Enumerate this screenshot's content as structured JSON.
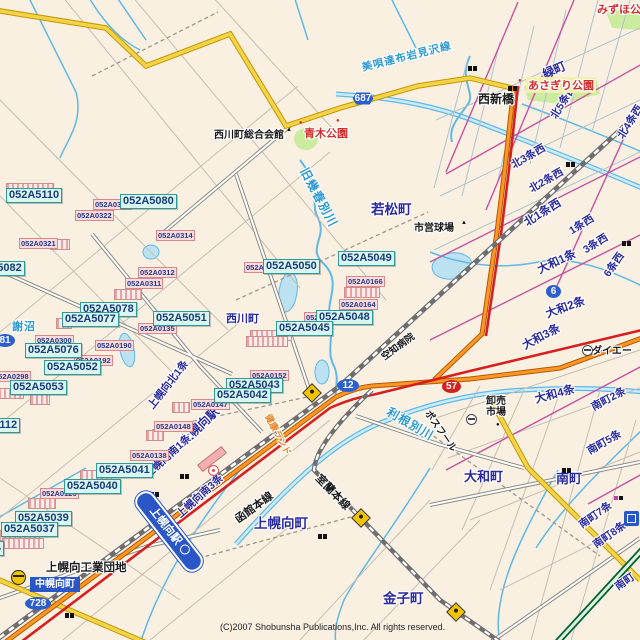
{
  "map": {
    "copyright": "(C)2007 Shobunsha Publications,Inc. All rights reserved.",
    "colors": {
      "bg": "#FAF0E2",
      "route_national": "#FF9726",
      "route_pref_yellow": "#F2D44A",
      "route_red": "#D62020",
      "river": "#5FB8E6",
      "park": "#CBEC9E",
      "railway": "#6E6E6E",
      "label_cyan_bg": "#DAF6F1",
      "label_pink_bg": "#FBDCDC",
      "shield_blue": "#2B5FD0",
      "expressway": "#006030"
    },
    "station_banner": {
      "label": "上幌向駅",
      "x": 121,
      "y": 521,
      "w": 92,
      "rot": 52
    },
    "town_box": {
      "label": "中幌向町",
      "x": 30,
      "y": 577,
      "w": 50
    },
    "code_labels_cyan": [
      {
        "text": "052A5112",
        "x": -36,
        "y": 418
      },
      {
        "text": "052A5110",
        "x": 6,
        "y": 188
      },
      {
        "text": "052A5080",
        "x": 120,
        "y": 194
      },
      {
        "text": "052A5082",
        "x": -32,
        "y": 261
      },
      {
        "text": "052A5078",
        "x": 80,
        "y": 302
      },
      {
        "text": "052A5077",
        "x": 62,
        "y": 312
      },
      {
        "text": "052A5051",
        "x": 153,
        "y": 311
      },
      {
        "text": "052A5076",
        "x": 25,
        "y": 343
      },
      {
        "text": "052A5052",
        "x": 44,
        "y": 360
      },
      {
        "text": "052A5053",
        "x": 10,
        "y": 380
      },
      {
        "text": "052A5050",
        "x": 263,
        "y": 259
      },
      {
        "text": "052A5049",
        "x": 338,
        "y": 251
      },
      {
        "text": "052A5048",
        "x": 316,
        "y": 310
      },
      {
        "text": "052A5045",
        "x": 276,
        "y": 321
      },
      {
        "text": "052A5043",
        "x": 226,
        "y": 378
      },
      {
        "text": "052A5042",
        "x": 214,
        "y": 388
      },
      {
        "text": "052A5041",
        "x": 96,
        "y": 463
      },
      {
        "text": "052A5040",
        "x": 64,
        "y": 479
      },
      {
        "text": "052A5039",
        "x": 15,
        "y": 511
      },
      {
        "text": "052A5037",
        "x": 1,
        "y": 522
      },
      {
        "text": "4",
        "x": -8,
        "y": 541
      }
    ],
    "code_labels_pink": [
      {
        "text": "052A0317",
        "x": 93,
        "y": 199
      },
      {
        "text": "052A0322",
        "x": 75,
        "y": 210
      },
      {
        "text": "052A0321",
        "x": 19,
        "y": 238
      },
      {
        "text": "052A0314",
        "x": 156,
        "y": 230
      },
      {
        "text": "052A0312",
        "x": 138,
        "y": 267
      },
      {
        "text": "052A0311",
        "x": 125,
        "y": 278
      },
      {
        "text": "052A0166",
        "x": 346,
        "y": 276
      },
      {
        "text": "052A0164",
        "x": 339,
        "y": 299
      },
      {
        "text": "052A0190",
        "x": 95,
        "y": 340
      },
      {
        "text": "052A0135",
        "x": 138,
        "y": 323
      },
      {
        "text": "052A0300",
        "x": 35,
        "y": 335
      },
      {
        "text": "052A0192",
        "x": 74,
        "y": 355
      },
      {
        "text": "052A0298",
        "x": -8,
        "y": 371
      },
      {
        "text": "052A0148",
        "x": 154,
        "y": 421
      },
      {
        "text": "052A0147",
        "x": 191,
        "y": 399
      },
      {
        "text": "052A0138",
        "x": 130,
        "y": 450
      },
      {
        "text": "052A0126",
        "x": 40,
        "y": 488
      },
      {
        "text": "052A0152",
        "x": 250,
        "y": 370
      },
      {
        "text": "052A",
        "x": 244,
        "y": 262
      },
      {
        "text": "052",
        "x": 304,
        "y": 312
      }
    ],
    "stack_bars": [
      {
        "x": 6,
        "y": 183,
        "w": 46
      },
      {
        "x": 50,
        "y": 239,
        "w": 18
      },
      {
        "x": 56,
        "y": 318,
        "w": 14
      },
      {
        "x": 114,
        "y": 289,
        "w": 26
      },
      {
        "x": -2,
        "y": 388,
        "w": 24
      },
      {
        "x": 30,
        "y": 394,
        "w": 18
      },
      {
        "x": 172,
        "y": 402,
        "w": 16
      },
      {
        "x": 146,
        "y": 430,
        "w": 16
      },
      {
        "x": 28,
        "y": 498,
        "w": 26
      },
      {
        "x": -2,
        "y": 530,
        "w": 40
      },
      {
        "x": 2,
        "y": 538,
        "w": 40
      },
      {
        "x": 250,
        "y": 330,
        "w": 40
      },
      {
        "x": 246,
        "y": 336,
        "w": 40
      },
      {
        "x": 344,
        "y": 287,
        "w": 34
      },
      {
        "x": 80,
        "y": 470,
        "w": 30
      }
    ],
    "district_labels": [
      {
        "text": "若松町",
        "x": 371,
        "y": 198,
        "fs": 13.5
      },
      {
        "text": "緑町",
        "x": 543,
        "y": 66,
        "fs": 12,
        "rot": -24
      },
      {
        "text": "北5条西",
        "x": 553,
        "y": 110,
        "fs": 10.5,
        "rot": -58
      },
      {
        "text": "北4条西",
        "x": 620,
        "y": 130,
        "fs": 10.5,
        "rot": -58
      },
      {
        "text": "北3条西",
        "x": 512,
        "y": 158,
        "fs": 10.5,
        "rot": -30
      },
      {
        "text": "北2条西",
        "x": 530,
        "y": 182,
        "fs": 10.5,
        "rot": -30
      },
      {
        "text": "北1条西",
        "x": 525,
        "y": 215,
        "fs": 11.5,
        "rot": -32
      },
      {
        "text": "1条西",
        "x": 570,
        "y": 224,
        "fs": 10.5,
        "rot": -32
      },
      {
        "text": "3条西",
        "x": 584,
        "y": 243,
        "fs": 10.5,
        "rot": -32
      },
      {
        "text": "6条西",
        "x": 606,
        "y": 268,
        "fs": 10.5,
        "rot": -55
      },
      {
        "text": "大和1条",
        "x": 538,
        "y": 262,
        "fs": 11.5,
        "rot": -25
      },
      {
        "text": "大和2条",
        "x": 546,
        "y": 306,
        "fs": 11.5,
        "rot": -20
      },
      {
        "text": "大和3条",
        "x": 523,
        "y": 338,
        "fs": 11.5,
        "rot": -28
      },
      {
        "text": "大和4条",
        "x": 535,
        "y": 391,
        "fs": 11.5,
        "rot": -15
      },
      {
        "text": "大和町",
        "x": 464,
        "y": 466,
        "fs": 13
      },
      {
        "text": "南町",
        "x": 556,
        "y": 468,
        "fs": 13
      },
      {
        "text": "南町2条",
        "x": 592,
        "y": 400,
        "fs": 10.5,
        "rot": -28
      },
      {
        "text": "南町5条",
        "x": 588,
        "y": 444,
        "fs": 10.5,
        "rot": -30
      },
      {
        "text": "南町7条",
        "x": 580,
        "y": 518,
        "fs": 10.5,
        "rot": -35
      },
      {
        "text": "南町8条",
        "x": 594,
        "y": 538,
        "fs": 10.5,
        "rot": -35
      },
      {
        "text": "南町",
        "x": 616,
        "y": 580,
        "fs": 10.5,
        "rot": -35
      },
      {
        "text": "上幌向町",
        "x": 254,
        "y": 512,
        "fs": 13.5
      },
      {
        "text": "金子町",
        "x": 383,
        "y": 587,
        "fs": 13.5
      },
      {
        "text": "上幌向北1条",
        "x": 150,
        "y": 400,
        "fs": 10.5,
        "rot": -52
      },
      {
        "text": "上幌向駅",
        "x": 182,
        "y": 434,
        "fs": 12,
        "rot": -44
      },
      {
        "text": "上幌向南1条",
        "x": 146,
        "y": 468,
        "fs": 10.5,
        "rot": -42
      },
      {
        "text": "上幌向南3条",
        "x": 178,
        "y": 508,
        "fs": 10.5,
        "rot": -42
      },
      {
        "text": "西川町",
        "x": 226,
        "y": 310,
        "fs": 11
      }
    ],
    "place_labels": [
      {
        "text": "西川町総合会館",
        "x": 214,
        "y": 126,
        "fs": 10
      },
      {
        "text": "西新橋",
        "x": 478,
        "y": 90,
        "fs": 12
      },
      {
        "text": "市営球場",
        "x": 414,
        "y": 219,
        "fs": 10
      },
      {
        "text": "卸売市場",
        "x": 486,
        "y": 396,
        "fs": 10,
        "w": 24,
        "cls": "wrap"
      },
      {
        "text": "ダイエー",
        "x": 592,
        "y": 342,
        "fs": 10
      },
      {
        "text": "ポスフール",
        "x": 428,
        "y": 404,
        "fs": 9.5,
        "rot": 55
      },
      {
        "text": "函館本線",
        "x": 236,
        "y": 512,
        "fs": 11,
        "rot": -36
      },
      {
        "text": "室蘭本線",
        "x": 318,
        "y": 468,
        "fs": 11,
        "rot": 46
      },
      {
        "text": "空知病院",
        "x": 382,
        "y": 350,
        "fs": 9.5,
        "rot": -36
      },
      {
        "text": "上幌向工業団地",
        "x": 46,
        "y": 559,
        "fs": 11.5
      }
    ],
    "leisure_labels": [
      {
        "text": "健康ランド",
        "x": 268,
        "y": 408,
        "fs": 9,
        "rot": 62
      }
    ],
    "water_labels": [
      {
        "text": "謝沼",
        "x": 12,
        "y": 318,
        "fs": 11
      },
      {
        "text": "旧幾春別川",
        "x": 304,
        "y": 160,
        "fs": 12,
        "rot": 62
      },
      {
        "text": "利根別川",
        "x": 388,
        "y": 402,
        "fs": 12,
        "rot": 30
      },
      {
        "text": "美唄達布岩見沢線",
        "x": 362,
        "y": 60,
        "fs": 10.5,
        "rot": -14
      }
    ],
    "park_labels": [
      {
        "text": "青木公園",
        "x": 304,
        "y": 125,
        "fs": 11
      },
      {
        "text": "あさぎり公園",
        "x": 526,
        "y": 77,
        "fs": 11,
        "cls": "bgyellow"
      },
      {
        "text": "みずほ公園",
        "x": 597,
        "y": 1,
        "fs": 11
      }
    ],
    "route_shields": [
      {
        "num": "687",
        "x": 350,
        "y": 92,
        "w": 26,
        "cls": "hex"
      },
      {
        "num": "12",
        "x": 337,
        "y": 379,
        "w": 22,
        "cls": "oval"
      },
      {
        "num": "6",
        "x": 546,
        "y": 285,
        "w": 15,
        "cls": "oval"
      },
      {
        "num": "57",
        "x": 442,
        "y": 380,
        "w": 19,
        "cls": "oval redshield"
      },
      {
        "num": "81",
        "x": -5,
        "y": 334,
        "w": 20,
        "cls": "oval"
      },
      {
        "num": "728",
        "x": 25,
        "y": 597,
        "w": 26,
        "cls": "oval"
      }
    ],
    "point_markers": [
      {
        "t": "▲",
        "x": 286,
        "y": 127,
        "cls": ""
      },
      {
        "t": "▲",
        "x": 461,
        "y": 220,
        "cls": ""
      },
      {
        "t": "●",
        "x": 496,
        "y": 422,
        "cls": ""
      },
      {
        "t": "●",
        "x": 299,
        "y": 120,
        "cls": "red"
      },
      {
        "t": "●",
        "x": 518,
        "y": 78,
        "cls": "red"
      },
      {
        "t": "●",
        "x": 336,
        "y": 118,
        "cls": "red"
      }
    ],
    "bridge_icons": [
      {
        "x": 468,
        "y": 66
      },
      {
        "x": 508,
        "y": 86
      },
      {
        "x": 566,
        "y": 162
      },
      {
        "x": 622,
        "y": 241
      },
      {
        "x": 180,
        "y": 474
      },
      {
        "x": 150,
        "y": 492
      },
      {
        "x": 318,
        "y": 534
      },
      {
        "x": 562,
        "y": 468
      },
      {
        "x": 65,
        "y": 613
      }
    ],
    "interchange_icons": [
      {
        "x": 305,
        "y": 386
      },
      {
        "x": 354,
        "y": 511
      },
      {
        "x": 449,
        "y": 605
      }
    ],
    "interchange_circle_icons": [
      {
        "x": 11,
        "y": 570
      }
    ],
    "store_icons": [
      {
        "x": 582,
        "y": 345
      },
      {
        "x": 466,
        "y": 414
      }
    ]
  }
}
